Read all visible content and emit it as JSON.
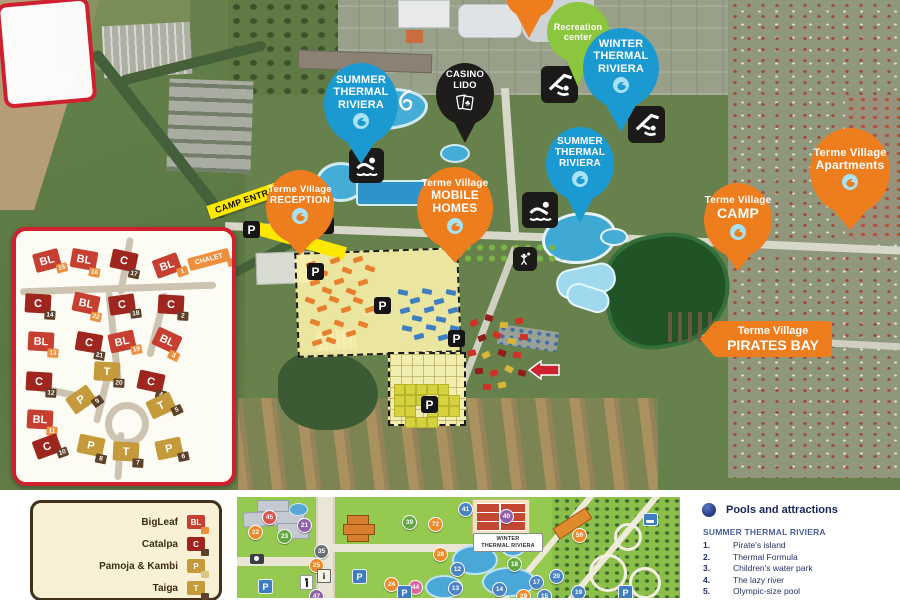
{
  "colors": {
    "pin_blue": "#1b9ad2",
    "pin_orange": "#ee7d1d",
    "pin_green": "#8cc63e",
    "pin_black": "#1e1d1b",
    "red_border": "#cf2030",
    "yellow_label": "#ffe800",
    "bl_block": "#c63f30",
    "c_block": "#9e261f",
    "t_block": "#c49a3a",
    "p_block": "#c49a3a",
    "tag_orange": "#ee8f3e",
    "tag_brown": "#5d412a",
    "tag_light": "#d9c786"
  },
  "pins": [
    {
      "name": "pin-recreation-center",
      "color": "green",
      "cx": 578,
      "cy": 32,
      "w": 62,
      "h": 60,
      "tip": 86,
      "icon": "",
      "lines": [
        {
          "t": "Recreation",
          "s": 9
        },
        {
          "t": "center",
          "s": 9
        }
      ]
    },
    {
      "name": "pin-winter-thermal-riviera",
      "color": "blue",
      "cx": 621,
      "cy": 68,
      "w": 76,
      "h": 80,
      "tip": 131,
      "icon": "wave",
      "lines": [
        {
          "t": "WINTER",
          "s": 11
        },
        {
          "t": "THERMAL",
          "s": 11
        },
        {
          "t": "RIVIERA",
          "s": 11
        }
      ]
    },
    {
      "name": "pin-summer-thermal-riviera-1",
      "color": "blue",
      "cx": 361,
      "cy": 104,
      "w": 74,
      "h": 82,
      "tip": 163,
      "icon": "wave",
      "lines": [
        {
          "t": "SUMMER",
          "s": 11
        },
        {
          "t": "THERMAL",
          "s": 11
        },
        {
          "t": "RIVIERA",
          "s": 11
        }
      ]
    },
    {
      "name": "pin-casino-lido",
      "color": "black",
      "cx": 465,
      "cy": 94,
      "w": 58,
      "h": 62,
      "tip": 142,
      "icon": "cards",
      "lines": [
        {
          "t": "CASINO",
          "s": 9.5
        },
        {
          "t": "LIDO",
          "s": 9.5
        }
      ]
    },
    {
      "name": "pin-summer-thermal-riviera-2",
      "color": "blue",
      "cx": 580,
      "cy": 164,
      "w": 68,
      "h": 74,
      "tip": 222,
      "icon": "wave",
      "lines": [
        {
          "t": "SUMMER",
          "s": 10
        },
        {
          "t": "THERMAL",
          "s": 10
        },
        {
          "t": "RIVIERA",
          "s": 10
        }
      ]
    },
    {
      "name": "pin-terme-village-reception",
      "color": "orange",
      "cx": 300,
      "cy": 207,
      "w": 68,
      "h": 74,
      "tip": 254,
      "icon": "wave",
      "lines": [
        {
          "t": "Terme Village",
          "s": 9.5
        },
        {
          "t": "RECEPTION",
          "s": 10
        }
      ]
    },
    {
      "name": "pin-terme-village-mobile-homes",
      "color": "orange",
      "cx": 455,
      "cy": 208,
      "w": 76,
      "h": 82,
      "tip": 262,
      "icon": "wave",
      "lines": [
        {
          "t": "Terme Village",
          "s": 10
        },
        {
          "t": "MOBILE",
          "s": 12
        },
        {
          "t": "HOMES",
          "s": 12
        }
      ]
    },
    {
      "name": "pin-terme-village-camp",
      "color": "orange",
      "cx": 738,
      "cy": 220,
      "w": 68,
      "h": 74,
      "tip": 270,
      "icon": "wave",
      "lines": [
        {
          "t": "Terme Village",
          "s": 10
        },
        {
          "t": "CAMP",
          "s": 14
        }
      ]
    },
    {
      "name": "pin-terme-village-apartments",
      "color": "orange",
      "cx": 850,
      "cy": 171,
      "w": 80,
      "h": 86,
      "tip": 229,
      "icon": "wave",
      "lines": [
        {
          "t": "Terme Village",
          "s": 11
        },
        {
          "t": "Apartments",
          "s": 12
        }
      ]
    }
  ],
  "banner": {
    "line1": "Terme Village",
    "line2": "PIRATES BAY"
  },
  "camp_entrance_label": "CAMP ENTRANCE",
  "parking_icons": [
    [
      243,
      221
    ],
    [
      317,
      217
    ],
    [
      307,
      263
    ],
    [
      374,
      297
    ],
    [
      448,
      330
    ],
    [
      421,
      396
    ]
  ],
  "activity_icons": [
    {
      "name": "indoor-pool-icon-1",
      "type": "indoor",
      "x": 541,
      "y": 66,
      "s": 37
    },
    {
      "name": "indoor-pool-icon-2",
      "type": "indoor",
      "x": 628,
      "y": 106,
      "s": 37
    },
    {
      "name": "swimmer-icon-1",
      "type": "swim",
      "x": 349,
      "y": 148,
      "s": 35
    },
    {
      "name": "swimmer-icon-2",
      "type": "swim",
      "x": 522,
      "y": 192,
      "s": 36
    },
    {
      "name": "volleyball-icon",
      "type": "volley",
      "x": 513,
      "y": 247,
      "s": 24
    }
  ],
  "slide_glyphs": [
    [
      378,
      94
    ],
    [
      395,
      89
    ]
  ],
  "orange_homes": [
    [
      306,
      262
    ],
    [
      318,
      270
    ],
    [
      330,
      258
    ],
    [
      342,
      268
    ],
    [
      353,
      257
    ],
    [
      365,
      266
    ],
    [
      310,
      280
    ],
    [
      322,
      288
    ],
    [
      334,
      279
    ],
    [
      346,
      289
    ],
    [
      358,
      280
    ],
    [
      305,
      298
    ],
    [
      317,
      306
    ],
    [
      329,
      297
    ],
    [
      341,
      307
    ],
    [
      353,
      298
    ],
    [
      365,
      307
    ],
    [
      310,
      320
    ],
    [
      322,
      330
    ],
    [
      334,
      321
    ],
    [
      346,
      331
    ],
    [
      358,
      322
    ],
    [
      312,
      340
    ],
    [
      326,
      338
    ]
  ],
  "blue_homes": [
    [
      398,
      290
    ],
    [
      410,
      298
    ],
    [
      422,
      289
    ],
    [
      434,
      299
    ],
    [
      446,
      290
    ],
    [
      400,
      308
    ],
    [
      412,
      316
    ],
    [
      424,
      307
    ],
    [
      436,
      317
    ],
    [
      448,
      308
    ],
    [
      402,
      326
    ],
    [
      414,
      334
    ],
    [
      426,
      325
    ],
    [
      438,
      335
    ],
    [
      450,
      326
    ]
  ],
  "yellow_cells": [
    [
      394,
      384
    ],
    [
      405,
      384
    ],
    [
      416,
      384
    ],
    [
      427,
      384
    ],
    [
      438,
      384
    ],
    [
      394,
      395
    ],
    [
      405,
      395
    ],
    [
      416,
      395
    ],
    [
      438,
      395
    ],
    [
      449,
      395
    ],
    [
      394,
      406
    ],
    [
      405,
      406
    ],
    [
      427,
      406
    ],
    [
      438,
      406
    ],
    [
      449,
      406
    ],
    [
      405,
      417
    ],
    [
      416,
      417
    ],
    [
      427,
      417
    ]
  ],
  "red_blocks": [
    [
      470,
      320,
      "r"
    ],
    [
      485,
      315,
      "d"
    ],
    [
      500,
      322,
      "y"
    ],
    [
      515,
      318,
      "r"
    ],
    [
      478,
      335,
      "d"
    ],
    [
      493,
      332,
      "r"
    ],
    [
      508,
      338,
      "y"
    ],
    [
      520,
      334,
      "r"
    ],
    [
      468,
      350,
      "r"
    ],
    [
      482,
      352,
      "y"
    ],
    [
      498,
      350,
      "d"
    ],
    [
      513,
      352,
      "r"
    ],
    [
      475,
      368,
      "d"
    ],
    [
      490,
      370,
      "r"
    ],
    [
      505,
      366,
      "y"
    ],
    [
      518,
      370,
      "d"
    ],
    [
      483,
      384,
      "r"
    ],
    [
      498,
      382,
      "y"
    ]
  ],
  "inset": {
    "chalet_label": "CHALET",
    "roads": [
      [
        16,
        281,
        196,
        7,
        -2
      ],
      [
        118,
        233,
        7,
        58,
        10
      ],
      [
        106,
        287,
        7,
        90,
        -6
      ],
      [
        96,
        360,
        7,
        60,
        14
      ],
      [
        22,
        386,
        80,
        7,
        12
      ],
      [
        112,
        428,
        7,
        48,
        4
      ],
      [
        150,
        288,
        7,
        66,
        14
      ]
    ],
    "roundabout": [
      101,
      398,
      30
    ],
    "blocks": [
      {
        "t": "BL",
        "n": "15",
        "x": 43,
        "y": 257,
        "r": -15
      },
      {
        "t": "BL",
        "n": "16",
        "x": 80,
        "y": 256,
        "r": 10
      },
      {
        "t": "C",
        "n": "17",
        "x": 120,
        "y": 257,
        "r": 12
      },
      {
        "t": "BL",
        "n": "1",
        "x": 163,
        "y": 262,
        "r": -20
      },
      {
        "t": "C",
        "n": "14",
        "x": 34,
        "y": 300,
        "r": 3
      },
      {
        "t": "BL",
        "n": "22",
        "x": 82,
        "y": 300,
        "r": 12
      },
      {
        "t": "C",
        "n": "18",
        "x": 118,
        "y": 301,
        "r": -8
      },
      {
        "t": "C",
        "n": "2",
        "x": 167,
        "y": 301,
        "r": 3
      },
      {
        "t": "BL",
        "n": "13",
        "x": 37,
        "y": 338,
        "r": 3
      },
      {
        "t": "C",
        "n": "21",
        "x": 85,
        "y": 339,
        "r": 10
      },
      {
        "t": "BL",
        "n": "19",
        "x": 118,
        "y": 338,
        "r": -12
      },
      {
        "t": "BL",
        "n": "3",
        "x": 163,
        "y": 337,
        "r": 25
      },
      {
        "t": "T",
        "n": "20",
        "x": 103,
        "y": 368,
        "r": 3
      },
      {
        "t": "C",
        "n": "12",
        "x": 35,
        "y": 378,
        "r": 3
      },
      {
        "t": "C",
        "n": "4",
        "x": 147,
        "y": 378,
        "r": 12
      },
      {
        "t": "P",
        "n": "9",
        "x": 77,
        "y": 396,
        "r": -35
      },
      {
        "t": "T",
        "n": "5",
        "x": 157,
        "y": 402,
        "r": -25
      },
      {
        "t": "BL",
        "n": "11",
        "x": 36,
        "y": 416,
        "r": 3
      },
      {
        "t": "C",
        "n": "10",
        "x": 43,
        "y": 443,
        "r": -20
      },
      {
        "t": "P",
        "n": "8",
        "x": 87,
        "y": 442,
        "r": 12
      },
      {
        "t": "T",
        "n": "7",
        "x": 122,
        "y": 448,
        "r": 3
      },
      {
        "t": "P",
        "n": "6",
        "x": 165,
        "y": 445,
        "r": -12
      }
    ]
  },
  "legend": {
    "items": [
      {
        "label": "BigLeaf",
        "code": "BL",
        "block": "bl_block",
        "tag": "tag_orange"
      },
      {
        "label": "Catalpa",
        "code": "C",
        "block": "c_block",
        "tag": "tag_brown"
      },
      {
        "label": "Pamoja & Kambi",
        "code": "P",
        "block": "p_block",
        "tag": "tag_light"
      },
      {
        "label": "Taiga",
        "code": "T",
        "block": "t_block",
        "tag": "tag_brown"
      }
    ]
  },
  "mini_map": {
    "label_lines": [
      "WINTER",
      "THERMAL RIVIERA"
    ],
    "badges": [
      {
        "n": "45",
        "x": 25,
        "y": 13,
        "c": "#d9544a"
      },
      {
        "n": "22",
        "x": 11,
        "y": 28,
        "c": "#ee8b28"
      },
      {
        "n": "21",
        "x": 60,
        "y": 21,
        "c": "#9061a8"
      },
      {
        "n": "23",
        "x": 40,
        "y": 32,
        "c": "#63a744"
      },
      {
        "n": "35",
        "x": 77,
        "y": 47,
        "c": "#6a7076"
      },
      {
        "n": "25",
        "x": 72,
        "y": 61,
        "c": "#ee8b28"
      },
      {
        "n": "47",
        "x": 72,
        "y": 92,
        "c": "#9061a8"
      },
      {
        "n": "39",
        "x": 165,
        "y": 18,
        "c": "#63a744"
      },
      {
        "n": "72",
        "x": 191,
        "y": 20,
        "c": "#ee8b28"
      },
      {
        "n": "28",
        "x": 196,
        "y": 50,
        "c": "#ee8b28"
      },
      {
        "n": "24",
        "x": 147,
        "y": 80,
        "c": "#ee8b28"
      },
      {
        "n": "44",
        "x": 171,
        "y": 83,
        "c": "#d9679e"
      },
      {
        "n": "12",
        "x": 213,
        "y": 65,
        "c": "#4a84c4"
      },
      {
        "n": "13",
        "x": 211,
        "y": 84,
        "c": "#4a84c4"
      },
      {
        "n": "41",
        "x": 221,
        "y": 5,
        "c": "#4a84c4"
      },
      {
        "n": "40",
        "x": 262,
        "y": 12,
        "c": "#9061a8"
      },
      {
        "n": "50",
        "x": 335,
        "y": 31,
        "c": "#ee8b28"
      },
      {
        "n": "18",
        "x": 270,
        "y": 60,
        "c": "#63a744"
      },
      {
        "n": "17",
        "x": 292,
        "y": 78,
        "c": "#4a84c4"
      },
      {
        "n": "20",
        "x": 312,
        "y": 72,
        "c": "#4a84c4"
      },
      {
        "n": "14",
        "x": 255,
        "y": 85,
        "c": "#4a84c4"
      },
      {
        "n": "29",
        "x": 279,
        "y": 92,
        "c": "#ee8b28"
      },
      {
        "n": "15",
        "x": 300,
        "y": 92,
        "c": "#4a84c4"
      },
      {
        "n": "19",
        "x": 334,
        "y": 88,
        "c": "#4a84c4"
      }
    ],
    "p_signs": [
      [
        21,
        82
      ],
      [
        115,
        72
      ],
      [
        160,
        88
      ],
      [
        381,
        88
      ]
    ],
    "i_sign": [
      80,
      72
    ],
    "bed_sign": [
      406,
      16
    ],
    "cam_sign": [
      13,
      57
    ],
    "walk_sign": [
      63,
      78
    ],
    "pools": [
      [
        215,
        48,
        42,
        26
      ],
      [
        245,
        70,
        50,
        26
      ],
      [
        188,
        78,
        34,
        20
      ],
      [
        264,
        42,
        20,
        14
      ]
    ],
    "circles": [
      [
        352,
        57,
        32
      ],
      [
        392,
        70,
        26
      ],
      [
        377,
        26,
        22
      ]
    ]
  },
  "attractions": {
    "title": "Pools and attractions",
    "section": "SUMMER THERMAL RIVIERA",
    "items": [
      "Pirate's island",
      "Thermal Formula",
      "Children's water park",
      "The lazy river",
      "Olympic-size pool",
      "Pools with underwater massage",
      "Boomerang toboggan"
    ]
  }
}
